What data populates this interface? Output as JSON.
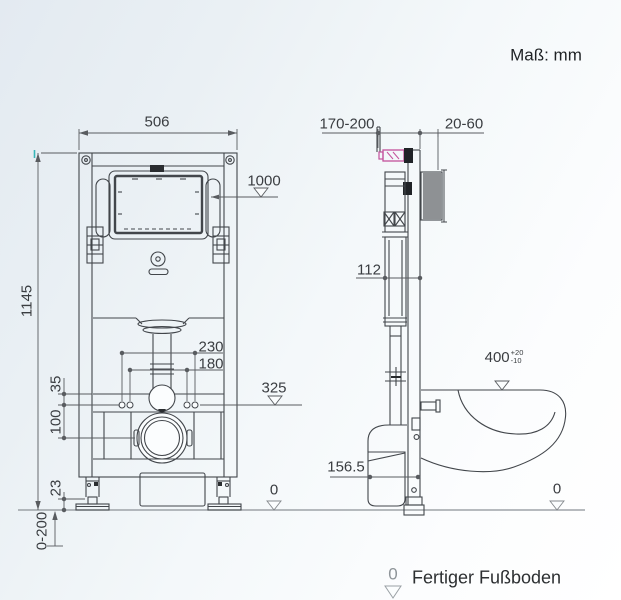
{
  "title": {
    "units": "Maß: mm"
  },
  "front": {
    "width": "506",
    "height": "1145",
    "panel_height": "1000",
    "fix_outer": "230",
    "fix_inner": "180",
    "rail_offset": "35",
    "drain_offset": "100",
    "supply_height": "325",
    "foot_height": "23",
    "adjust_range": "0-200",
    "floor_zero": "0"
  },
  "side": {
    "frame_depth": "170-200",
    "wall_thickness": "20-60",
    "cistern_depth": "112",
    "bowl_height": "400",
    "bowl_tol_plus": "+20",
    "bowl_tol_minus": "-10",
    "outlet_height": "156.5",
    "floor_zero": "0"
  },
  "legend": {
    "symbol": "0",
    "label": "Fertiger Fußboden"
  },
  "colors": {
    "line": "#42464b",
    "dim_line": "#595c60",
    "valve_accent": "#c4519c",
    "teal_mark": "#36b6b8",
    "floor_line": "#8d9297",
    "fill_occlude": "#fbfdfe"
  }
}
